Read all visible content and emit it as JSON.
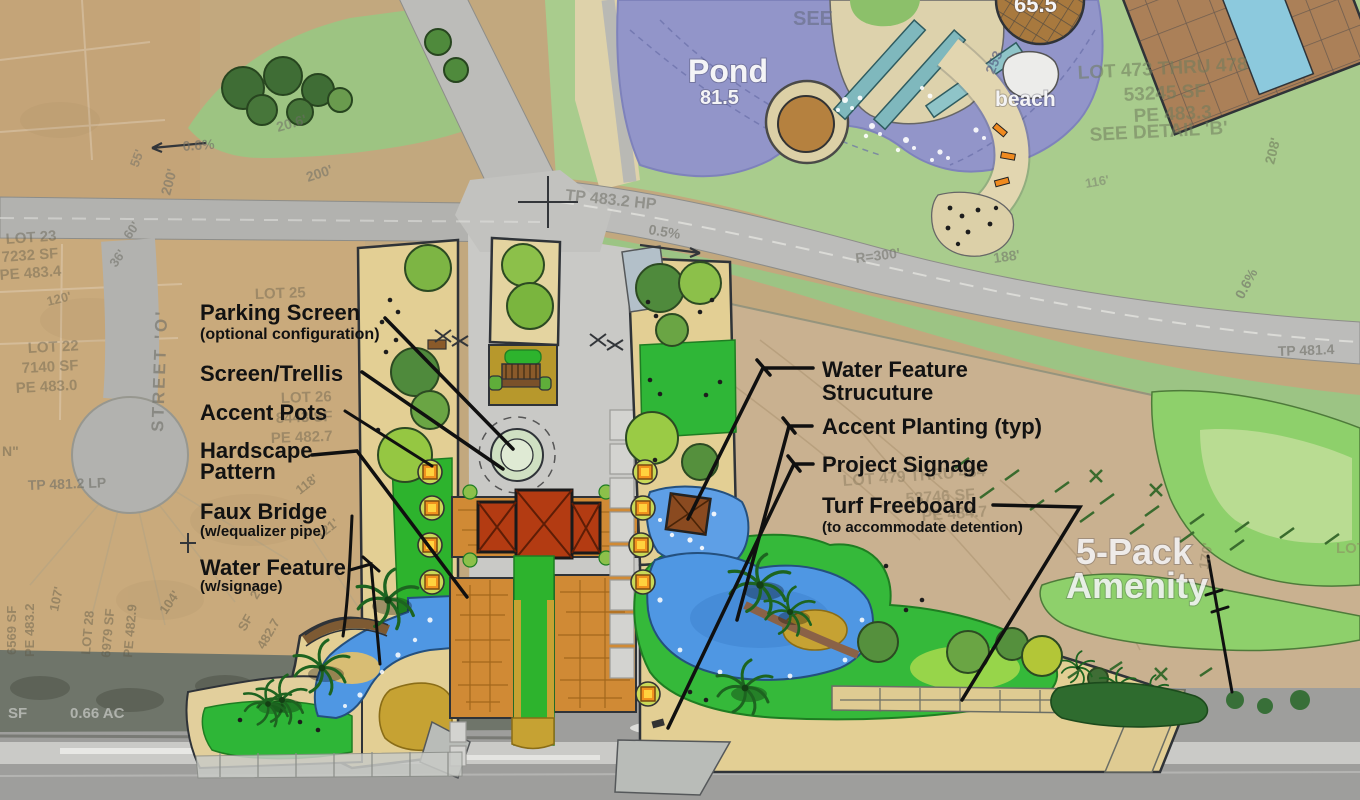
{
  "labels": {
    "pond": "Pond",
    "pond_elevation": "81.5",
    "beach": "beach",
    "deck_elevation": "65.5",
    "see_note": "SEE",
    "amenity_title_line1": "5-Pack",
    "amenity_title_line2": "Amenity"
  },
  "callouts_left": [
    {
      "title": "Parking Screen",
      "subtitle": "(optional configuration)"
    },
    {
      "title": "Screen/Trellis"
    },
    {
      "title": "Accent Pots"
    },
    {
      "title": "Hardscape",
      "title2": "Pattern"
    },
    {
      "title": "Faux Bridge",
      "subtitle": "(w/equalizer pipe)"
    },
    {
      "title": "Water Feature",
      "subtitle": "(w/signage)"
    }
  ],
  "callouts_right": [
    {
      "title": "Water Feature",
      "title2": "Strucuture"
    },
    {
      "title": "Accent Planting (typ)"
    },
    {
      "title": "Project Signage"
    },
    {
      "title": "Turf Freeboard",
      "subtitle": "(to accommodate detention)"
    }
  ],
  "survey": [
    {
      "t": "LOT 23"
    },
    {
      "t": "7232 SF"
    },
    {
      "t": "PE 483.4"
    },
    {
      "t": "120'"
    },
    {
      "t": "LOT 22"
    },
    {
      "t": "7140 SF"
    },
    {
      "t": "PE 483.0"
    },
    {
      "t": "STREET 'O'"
    },
    {
      "t": "36'"
    },
    {
      "t": "60'"
    },
    {
      "t": "TP 481.2 LP"
    },
    {
      "t": "N\""
    },
    {
      "t": "LOT 25"
    },
    {
      "t": "LOT 26"
    },
    {
      "t": "8443 SF"
    },
    {
      "t": "PE 482.7"
    },
    {
      "t": "118'"
    },
    {
      "t": "121'"
    },
    {
      "t": "6569 SF"
    },
    {
      "t": "PE 483.2"
    },
    {
      "t": "107'"
    },
    {
      "t": "LOT 28"
    },
    {
      "t": "6979 SF"
    },
    {
      "t": "PE 482.9"
    },
    {
      "t": "104'"
    },
    {
      "t": "27"
    },
    {
      "t": "SF"
    },
    {
      "t": "482.7"
    },
    {
      "t": "SF"
    },
    {
      "t": "0.66 AC"
    },
    {
      "t": "TP 483.2 HP"
    },
    {
      "t": "0.5%"
    },
    {
      "t": "0.6%"
    },
    {
      "t": "0.6%"
    },
    {
      "t": "TP 481.4"
    },
    {
      "t": "200'"
    },
    {
      "t": "200'"
    },
    {
      "t": "20.6'"
    },
    {
      "t": "55'"
    },
    {
      "t": "253"
    },
    {
      "t": "LOT 473 THRU 478"
    },
    {
      "t": "53245 SF"
    },
    {
      "t": "PE 483.3"
    },
    {
      "t": "SEE DETAIL 'B'"
    },
    {
      "t": "208'"
    },
    {
      "t": "LOT 479 THRU 484"
    },
    {
      "t": "53746 SF"
    },
    {
      "t": "PE 484.7"
    },
    {
      "t": "170'"
    },
    {
      "t": "LOT"
    },
    {
      "t": "R=300'"
    },
    {
      "t": "188'"
    },
    {
      "t": "116'"
    }
  ],
  "colors": {
    "pond_water": "#9295c9",
    "amenity_water": "#4f97e3",
    "amenity_lawn": "#2db32d",
    "hardscape_orange": "#d08a35",
    "pavilion_roof": "#b33b12",
    "amenity_sand": "#e3cf94",
    "park_green": "#a9cc8d",
    "turf_green": "#8ed06b",
    "dirt_tan": "#c9b190",
    "road_gray": "#bdbdba",
    "callout_text": "#121212",
    "white_label": "#f4f4f6"
  }
}
